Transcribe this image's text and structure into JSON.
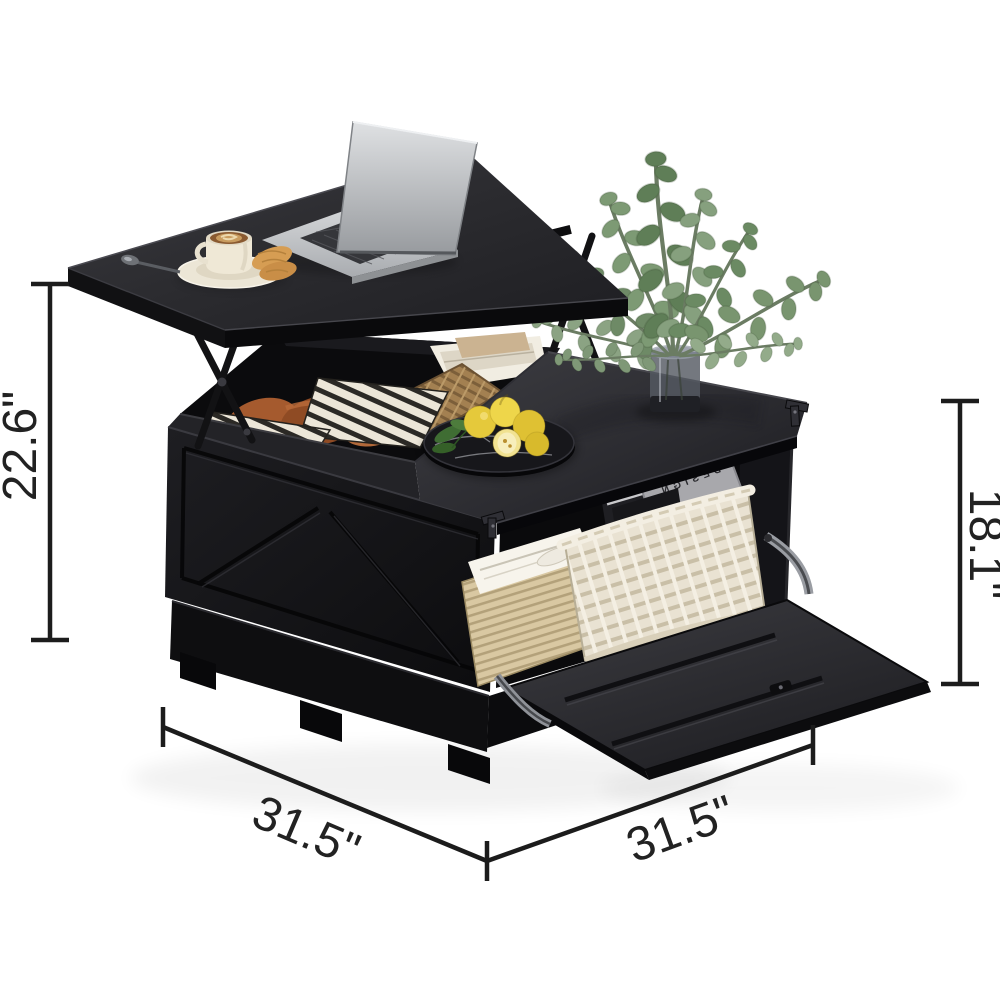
{
  "page": {
    "background_color": "#ffffff"
  },
  "figure": {
    "type": "product-photo",
    "subject": "black farmhouse lift-top square coffee table with hidden storage",
    "scene_items": [
      "laptop",
      "coffee-cup-with-saucer",
      "croissants",
      "teaspoon",
      "eucalyptus-in-glass-vase",
      "round-marble-tray",
      "yellow-fruits",
      "striped-blanket",
      "rust-throw-pillows",
      "wicker-basket",
      "white-woven-basket",
      "magazines",
      "newspapers",
      "striped-storage-box",
      "drop-down-front-door",
      "lift-up-top-mechanism"
    ]
  },
  "decor_text": {
    "magazine_title_line1": "ARCHITEKTURA",
    "magazine_title_line2": "D E S I G N",
    "magazine_title_small": "domus"
  },
  "dimensions": {
    "overall_height": "22.6\"",
    "cabinet_height": "18.1\"",
    "width": "31.5\"",
    "depth": "31.5\""
  },
  "colors": {
    "table_black": "#131316",
    "tabletop_gray": "#323237",
    "dimension_line": "#1c1c1c",
    "label_text": "#222222",
    "plant_green": "#7d9a74",
    "basket_cream": "#e9e2d2",
    "pillow_rust": "#a55a2e"
  }
}
